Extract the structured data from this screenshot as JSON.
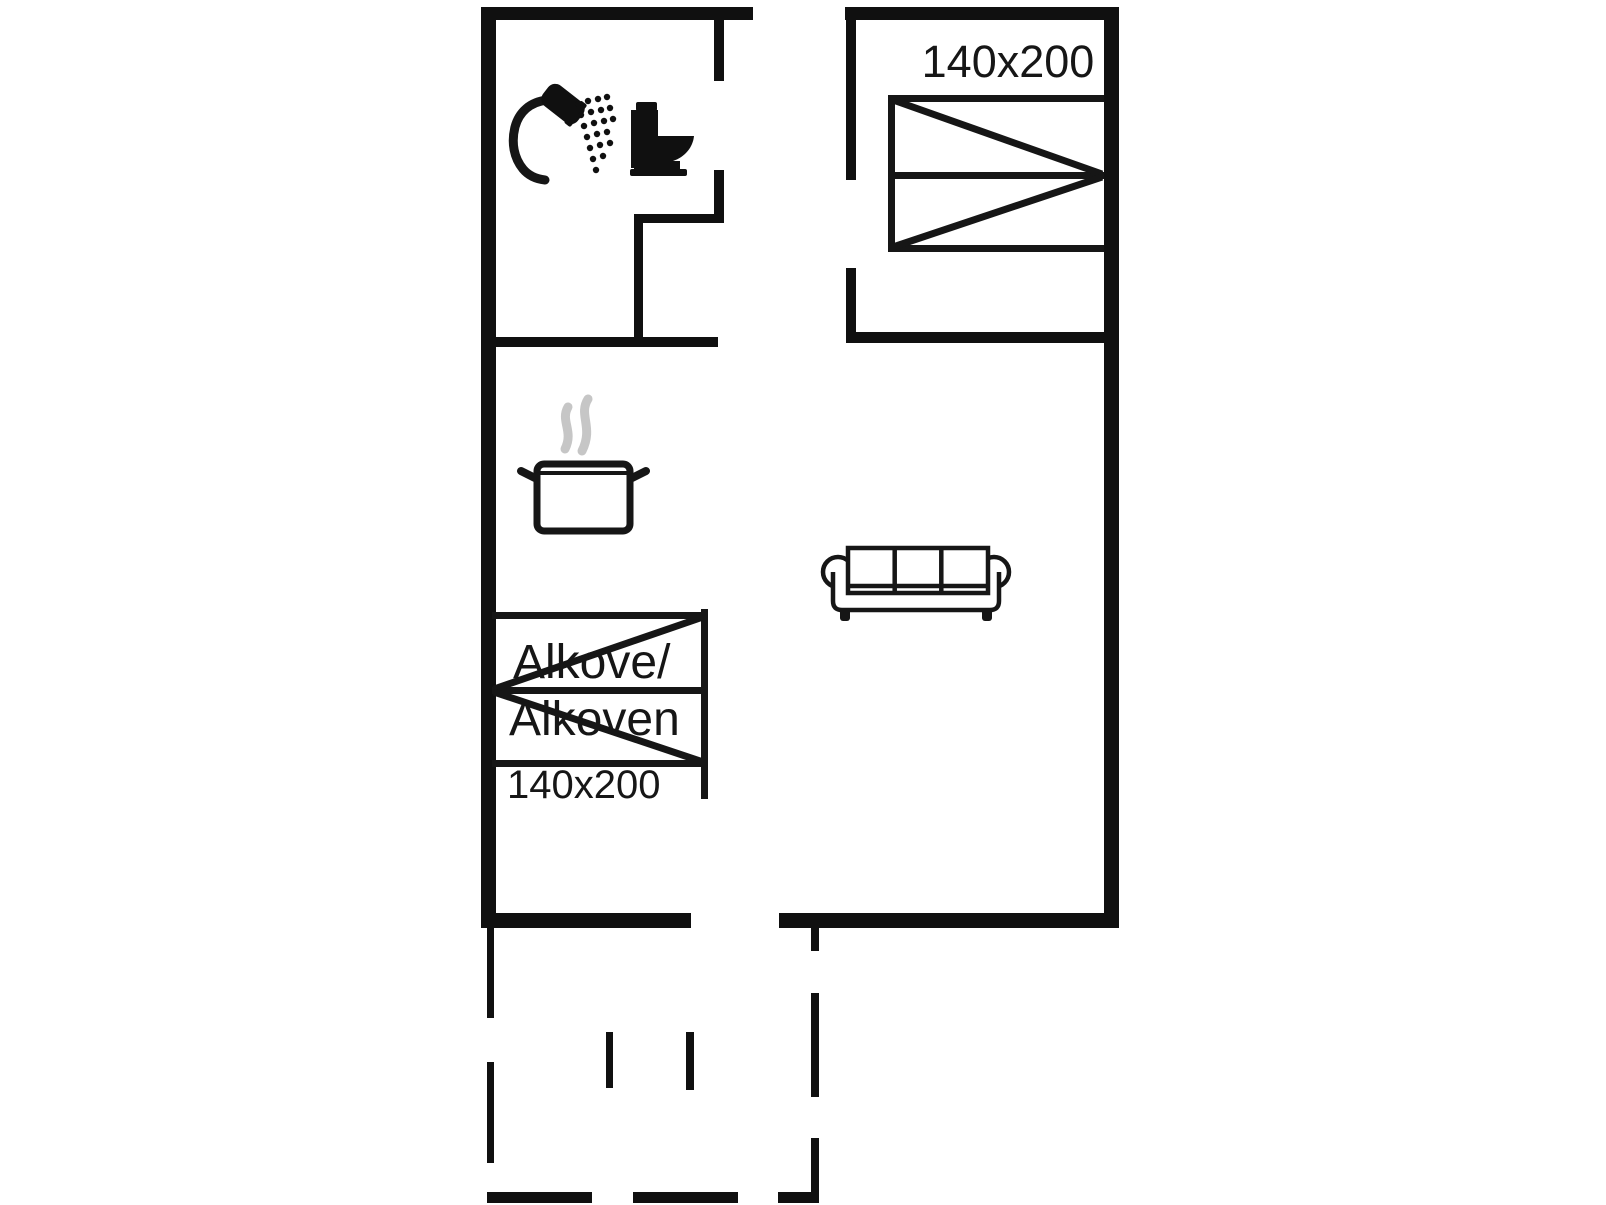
{
  "floorplan": {
    "title": "holiday-home-floor-plan",
    "bedroom": {
      "bed_size_label": "140x200",
      "icon": "double-bed-icon"
    },
    "alcove": {
      "label_line1": "Alkove/",
      "label_line2": "Alkoven",
      "bed_size_label": "140x200",
      "icon": "alcove-bed-icon"
    },
    "bathroom": {
      "icons": [
        "shower-icon",
        "toilet-icon"
      ]
    },
    "kitchen": {
      "icons": [
        "cooking-pot-icon",
        "steam-icon"
      ]
    },
    "living_room": {
      "icons": [
        "sofa-icon"
      ]
    },
    "terrace": {
      "style": "dashed-outline"
    },
    "colors": {
      "wall": "#101010",
      "line": "#161616",
      "steam": "#c6c6c6",
      "background": "#ffffff",
      "fill_white": "#ffffff"
    }
  }
}
